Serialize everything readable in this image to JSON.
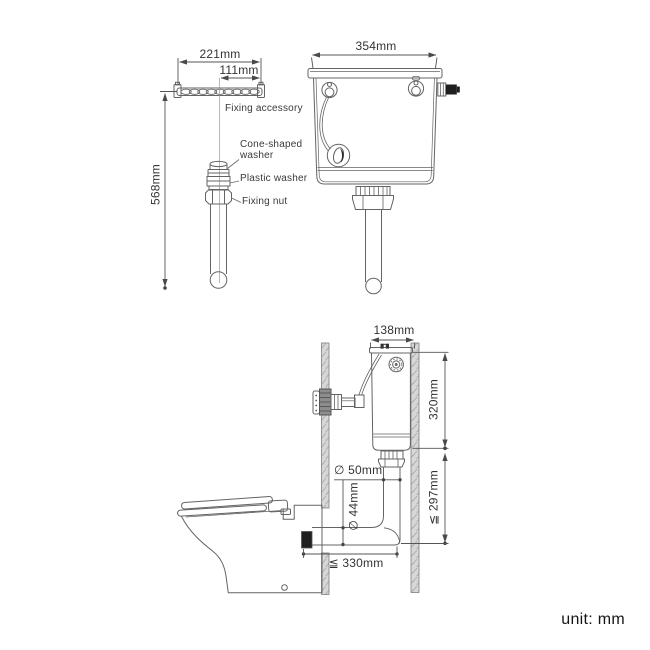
{
  "accessory_view": {
    "dim_outer_width": "221mm",
    "dim_inner_width": "111mm",
    "dim_total_height": "568mm",
    "label_fixing_accessory": "Fixing accessory",
    "label_cone_washer_line1": "Cone-shaped",
    "label_cone_washer_line2": "washer",
    "label_plastic_washer": "Plastic washer",
    "label_fixing_nut": "Fixing nut"
  },
  "cistern_front_view": {
    "dim_width": "354mm"
  },
  "installation_view": {
    "dim_cistern_depth": "138mm",
    "dim_cistern_height": "320mm",
    "dim_flush_pipe_max_height": "≦ 297mm",
    "dim_flush_pipe_outer_diameter": "∅ 50mm",
    "dim_flush_pipe_inner_diameter": "∅ 44mm",
    "dim_setout_max": "≦ 330mm"
  },
  "footer": {
    "unit_note": "unit: mm"
  },
  "colors": {
    "line": "#646464",
    "dimension_line": "#4f4f4f",
    "text": "#333333",
    "wall_fill": "#d7d7d7",
    "solid_black_parts": "#1f1f1f"
  }
}
